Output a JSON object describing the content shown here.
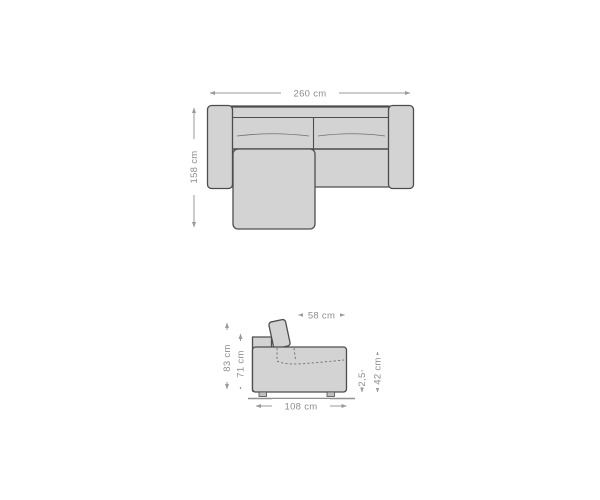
{
  "diagram": {
    "title": "sofa-dimension-drawing",
    "colors": {
      "sofa_fill": "#d3d3d3",
      "outline": "#4d4d4d",
      "seam": "#6f6f6f",
      "dim": "#9a9a9a",
      "text_dim": "#8d8d8d",
      "foot": "#c0c0c0",
      "ground": "#8f8f8f"
    },
    "top_view": {
      "name": "sofa seen from above with chaise longue",
      "dimensions": {
        "width": "260 cm",
        "depth": "158 cm"
      }
    },
    "side_view": {
      "name": "sofa seen from the side with headrest",
      "dimensions": {
        "seat_depth": "58 cm",
        "total_height": "83 cm",
        "back_height": "71 cm",
        "foot_height": "2,5",
        "seat_height": "42 cm",
        "depth": "108 cm"
      }
    }
  }
}
